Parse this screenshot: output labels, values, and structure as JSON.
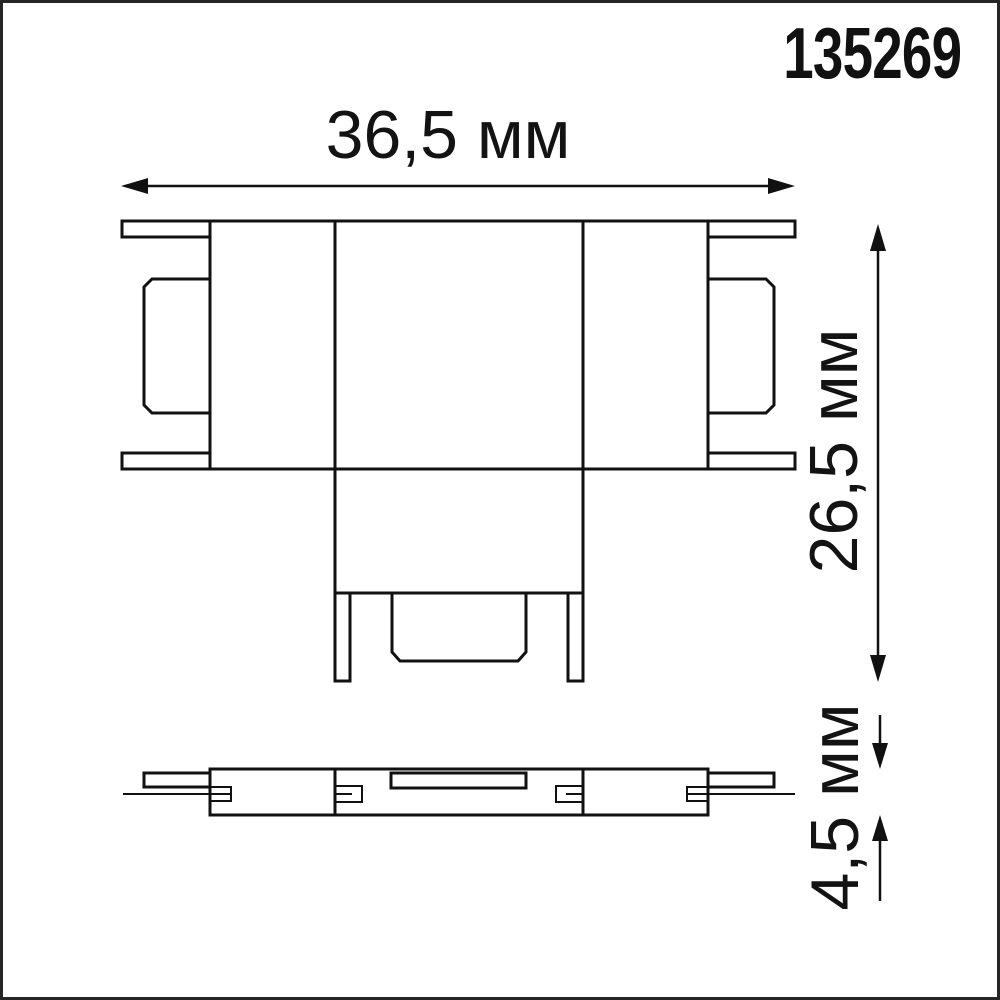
{
  "article": "135269",
  "dimensions": {
    "width_label": "36,5 мм",
    "height_label": "26,5 мм",
    "thickness_label": "4,5 мм"
  },
  "colors": {
    "line": "#111111",
    "background": "#ffffff",
    "frame": "#262626"
  }
}
